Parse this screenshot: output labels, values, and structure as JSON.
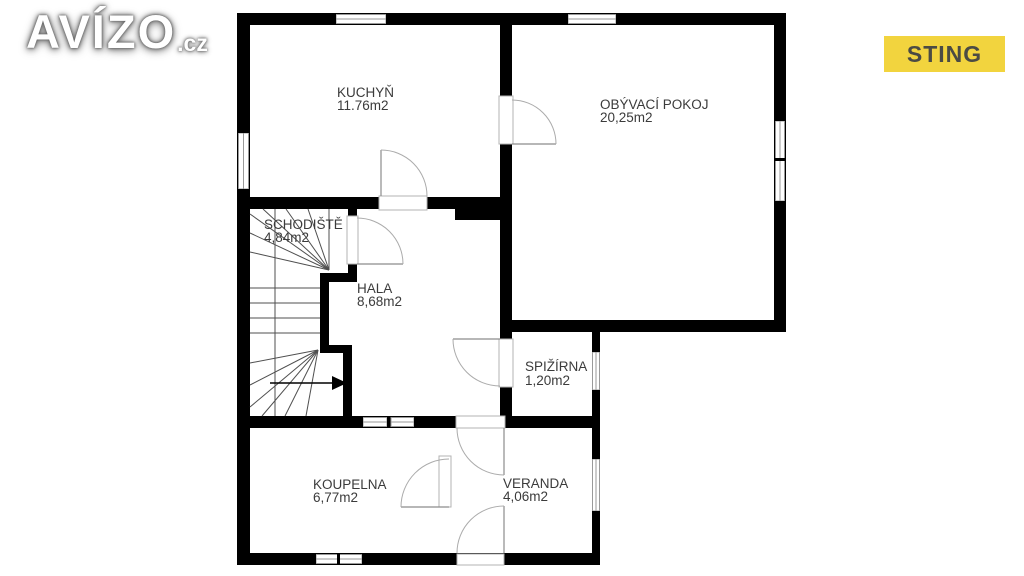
{
  "header": {
    "logo": {
      "main": "AVÍZO",
      "suffix": ".cz"
    },
    "agency_badge": {
      "label": "STING",
      "bg_color": "#F2D43E",
      "text_color": "#4B4B44"
    }
  },
  "floor_plan": {
    "rooms": [
      {
        "name": "KUCHYŇ",
        "area": "11.76m2"
      },
      {
        "name": "OBÝVACÍ POKOJ",
        "area": "20,25m2"
      },
      {
        "name": "SCHODIŠTĚ",
        "area": "4,84m2"
      },
      {
        "name": "HALA",
        "area": "8,68m2"
      },
      {
        "name": "SPIŽÍRNA",
        "area": "1,20m2"
      },
      {
        "name": "KOUPELNA",
        "area": "6,77m2"
      },
      {
        "name": "VERANDA",
        "area": "4,06m2"
      }
    ],
    "wall_color": "#000000",
    "window_color": "#9a9a9a",
    "door_arc_color": "#ababab",
    "stair_line_color": "#4f4f4f",
    "label_color": "#3b3b3b"
  }
}
